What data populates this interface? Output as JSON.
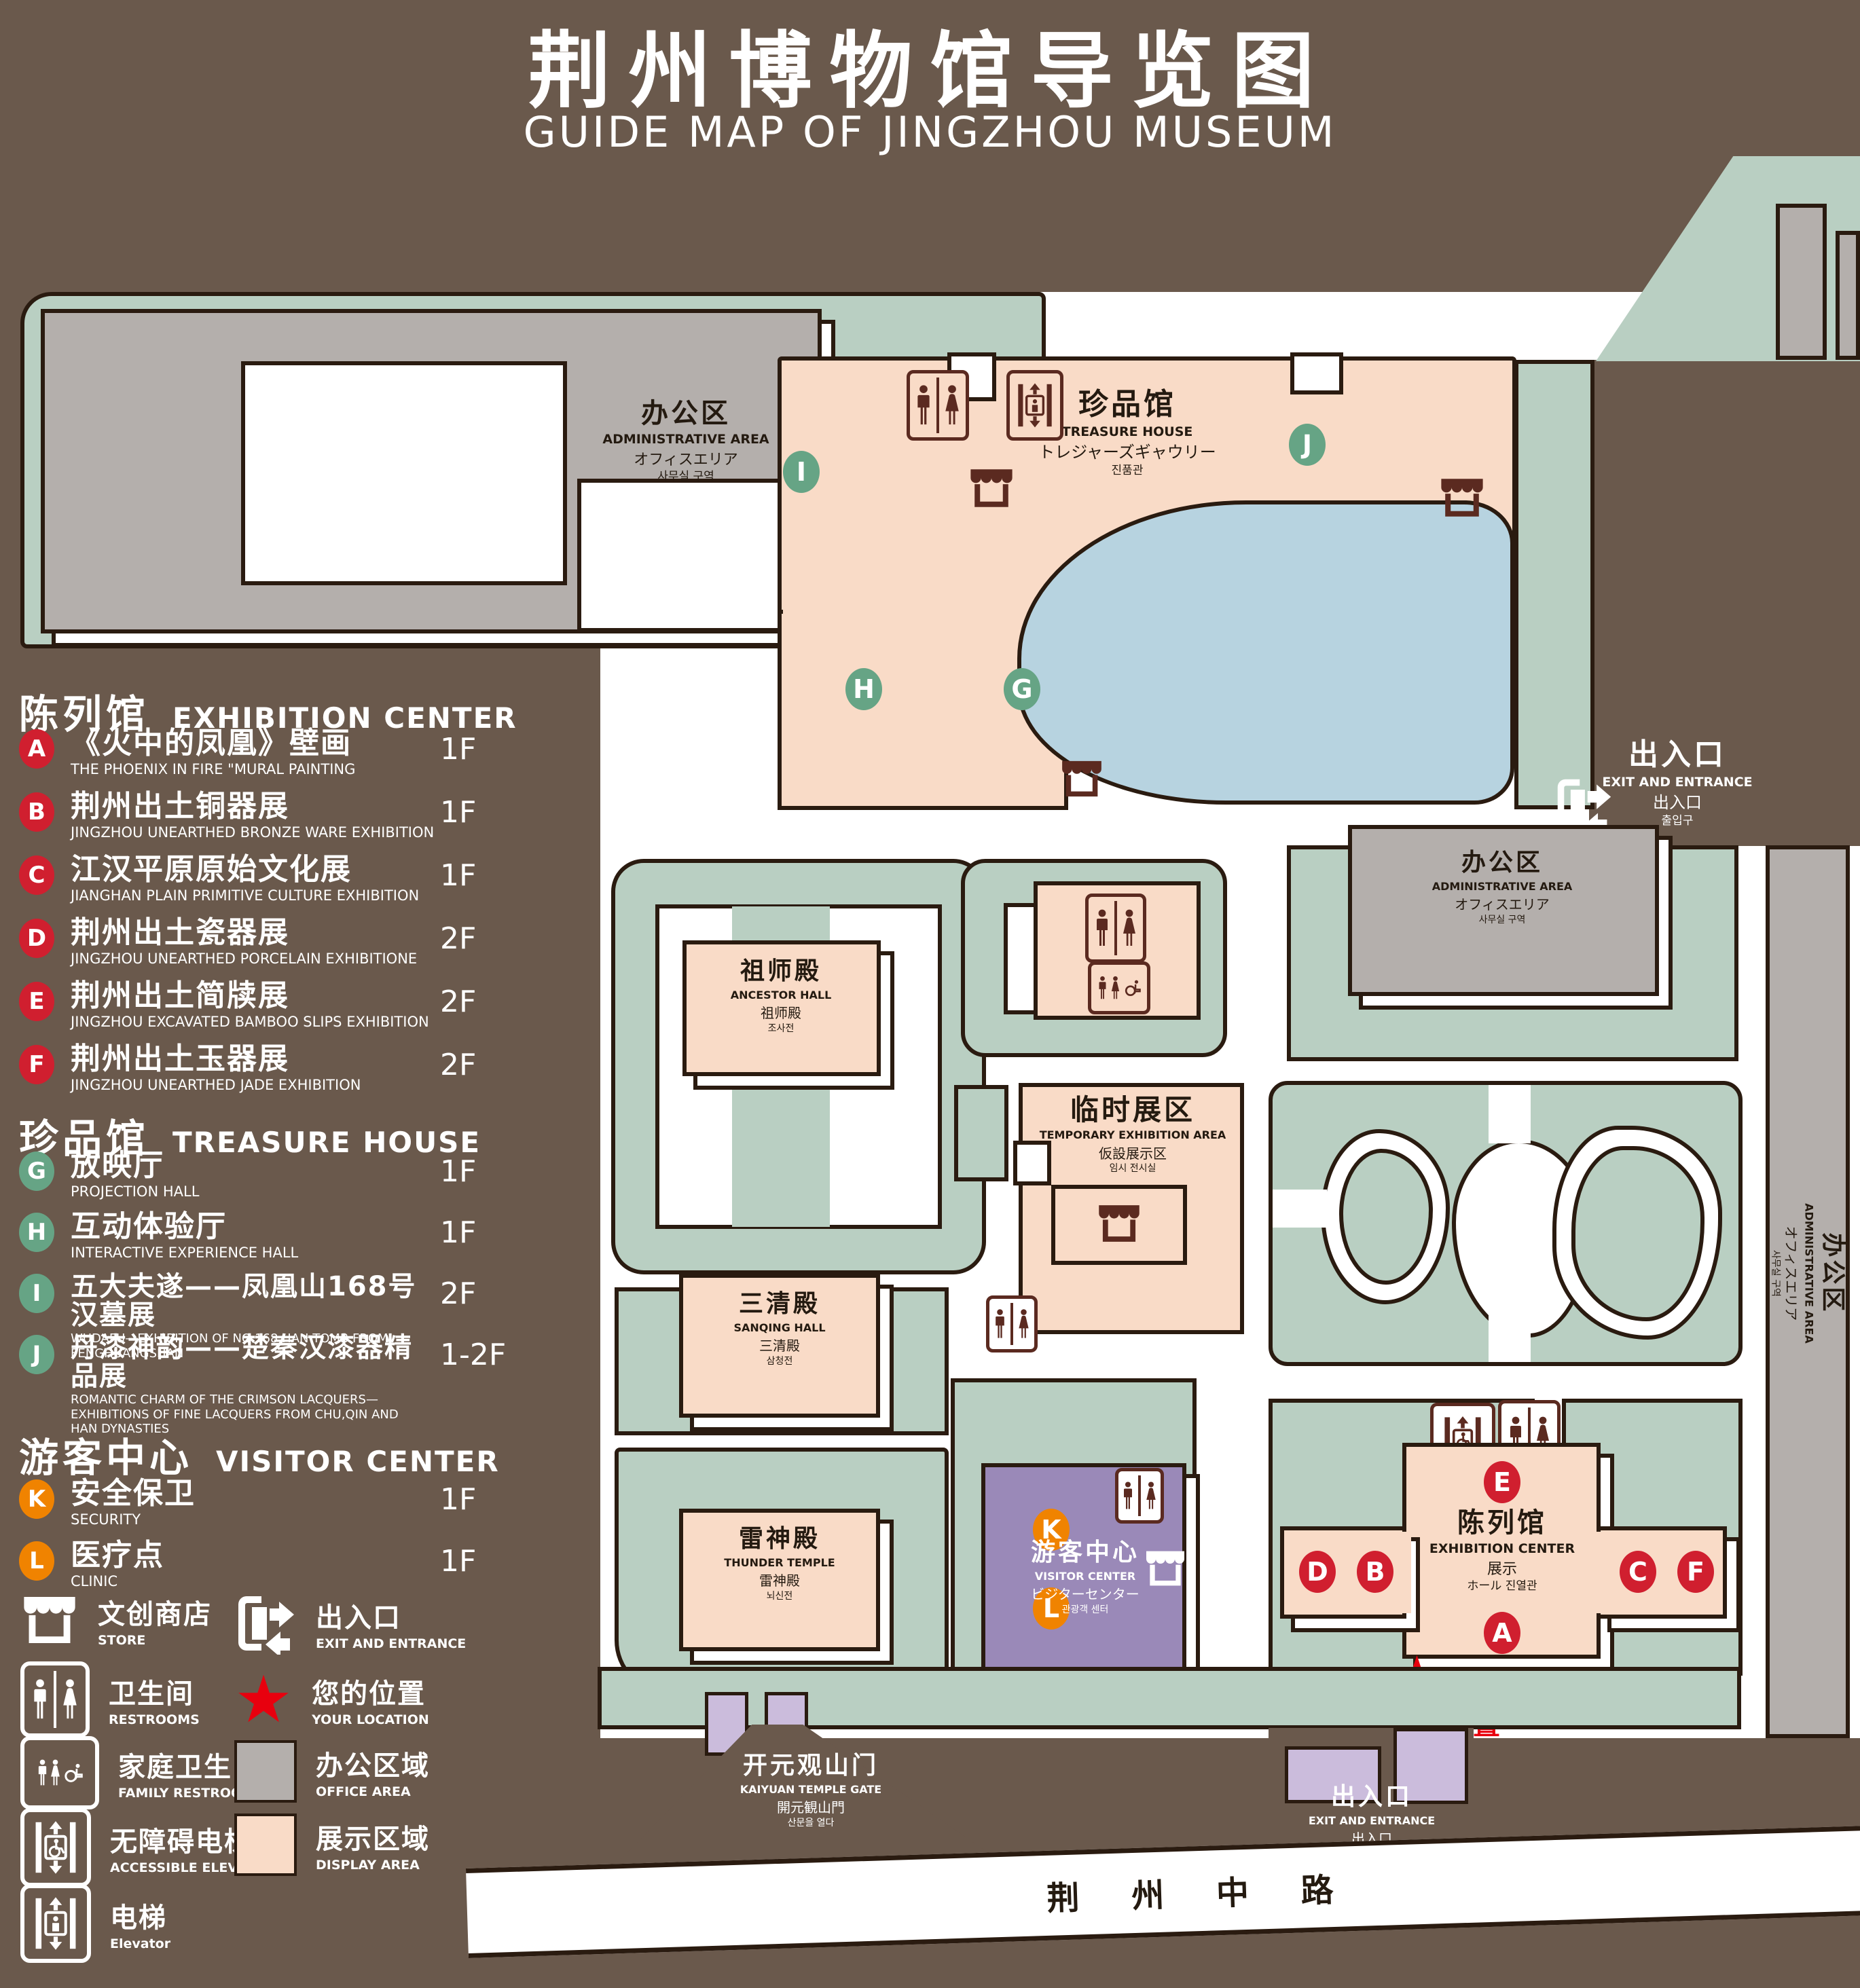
{
  "title": {
    "zh": "荆州博物馆导览图",
    "en": "GUIDE MAP OF JINGZHOU MUSEUM"
  },
  "colors": {
    "background": "#6a594c",
    "green": "#b9cfc2",
    "pink": "#f9dbc7",
    "gray": "#b4afac",
    "blue": "#b7d3e0",
    "purple": "#9a89b8",
    "purple_light": "#cbbcdc",
    "badge_red": "#d01f2f",
    "badge_green": "#66a485",
    "badge_orange": "#f08300",
    "location_red": "#e8000e",
    "outline": "#2a1b10"
  },
  "legend": {
    "exhibition": {
      "zh": "陈列馆",
      "en": "EXHIBITION CENTER",
      "items": [
        {
          "id": "A",
          "zh": "《火中的凤凰》壁画",
          "en": "THE PHOENIX IN FIRE \"MURAL PAINTING",
          "floor": "1F"
        },
        {
          "id": "B",
          "zh": "荆州出土铜器展",
          "en": "JINGZHOU UNEARTHED BRONZE WARE EXHIBITION",
          "floor": "1F"
        },
        {
          "id": "C",
          "zh": "江汉平原原始文化展",
          "en": "JIANGHAN PLAIN PRIMITIVE CULTURE EXHIBITION",
          "floor": "1F"
        },
        {
          "id": "D",
          "zh": "荆州出土瓷器展",
          "en": "JINGZHOU UNEARTHED PORCELAIN EXHIBITIONE",
          "floor": "2F"
        },
        {
          "id": "E",
          "zh": "荆州出土简牍展",
          "en": "JINGZHOU EXCAVATED BAMBOO SLIPS EXHIBITION",
          "floor": "2F"
        },
        {
          "id": "F",
          "zh": "荆州出土玉器展",
          "en": "JINGZHOU UNEARTHED JADE EXHIBITION",
          "floor": "2F"
        }
      ]
    },
    "treasure": {
      "zh": "珍品馆",
      "en": "TREASURE HOUSE",
      "items": [
        {
          "id": "G",
          "zh": "放映厅",
          "en": "PROJECTION HALL",
          "floor": "1F"
        },
        {
          "id": "H",
          "zh": "互动体验厅",
          "en": "INTERACTIVE EXPERIENCE HALL",
          "floor": "1F"
        },
        {
          "id": "I",
          "zh": "五大夫遂——凤凰山168号汉墓展",
          "en": "WUDAFU—EXHIBITION OF NO.168 HAN TOMB FROM FENGHUANGSHAN",
          "floor": "2F"
        },
        {
          "id": "J",
          "zh": "丹漆神韵——楚秦汉漆器精品展",
          "en": "ROMANTIC CHARM OF THE CRIMSON LACQUERS—EXHIBITIONS OF FINE LACQUERS FROM CHU,QIN AND HAN DYNASTIES",
          "floor": "1-2F"
        }
      ]
    },
    "visitor": {
      "zh": "游客中心",
      "en": "VISITOR CENTER",
      "items": [
        {
          "id": "K",
          "zh": "安全保卫",
          "en": "SECURITY",
          "floor": "1F"
        },
        {
          "id": "L",
          "zh": "医疗点",
          "en": "CLINIC",
          "floor": "1F"
        }
      ]
    },
    "symbols": [
      {
        "icon": "store-icon",
        "zh": "文创商店",
        "en": "STORE"
      },
      {
        "icon": "exit-icon",
        "zh": "出入口",
        "en": "EXIT AND ENTRANCE"
      },
      {
        "icon": "restrooms-icon",
        "zh": "卫生间",
        "en": "RESTROOMS"
      },
      {
        "icon": "your-location-star-icon",
        "zh": "您的位置",
        "en": "YOUR LOCATION"
      },
      {
        "icon": "family-restrooms-icon",
        "zh": "家庭卫生间",
        "en": "FAMILY RESTROOMS"
      },
      {
        "icon": "office-area-swatch",
        "zh": "办公区域",
        "en": "OFFICE AREA"
      },
      {
        "icon": "accessible-elevator-icon",
        "zh": "无障碍电梯",
        "en": "ACCESSIBLE ELEVATOR"
      },
      {
        "icon": "display-area-swatch",
        "zh": "展示区域",
        "en": "DISPLAY AREA"
      },
      {
        "icon": "elevator-icon",
        "zh": "电梯",
        "en": "Elevator"
      }
    ]
  },
  "map": {
    "admin": {
      "zh": "办公区",
      "en": "ADMINISTRATIVE AREA",
      "ja": "オフィスエリア",
      "ko": "사무실 구역"
    },
    "treasure_house": {
      "zh": "珍品馆",
      "en": "TREASURE HOUSE",
      "ja": "トレジャーズギャウリー",
      "ko": "진품관"
    },
    "exit": {
      "zh": "出入口",
      "en": "EXIT AND ENTRANCE",
      "ja": "出入口",
      "ko": "출입구"
    },
    "ancestor_hall": {
      "zh": "祖师殿",
      "en": "ANCESTOR HALL",
      "ja": "祖师殿",
      "ko": "조사전"
    },
    "temporary": {
      "zh": "临时展区",
      "en": "TEMPORARY EXHIBITION AREA",
      "ja": "仮設展示区",
      "ko": "임시 전시실"
    },
    "sanqing_hall": {
      "zh": "三清殿",
      "en": "SANQING HALL",
      "ja": "三清殿",
      "ko": "삼청전"
    },
    "thunder_temple": {
      "zh": "雷神殿",
      "en": "THUNDER TEMPLE",
      "ja": "雷神殿",
      "ko": "뇌신전"
    },
    "visitor_center": {
      "zh": "游客中心",
      "en": "VISITOR CENTER",
      "ja": "ビジターセンター",
      "ko": "관광객 센터"
    },
    "exhibition_center": {
      "zh": "陈列馆",
      "en": "EXHIBITION CENTER",
      "ja": "展示",
      "ko": "ホール 진열관"
    },
    "gate": {
      "zh": "开元观山门",
      "en": "KAIYUAN TEMPLE GATE",
      "ja": "開元観山門",
      "ko": "산문을 열다"
    },
    "your_location": {
      "zh": "您的位置"
    },
    "road": {
      "zh": "荆 州 中 路"
    }
  }
}
